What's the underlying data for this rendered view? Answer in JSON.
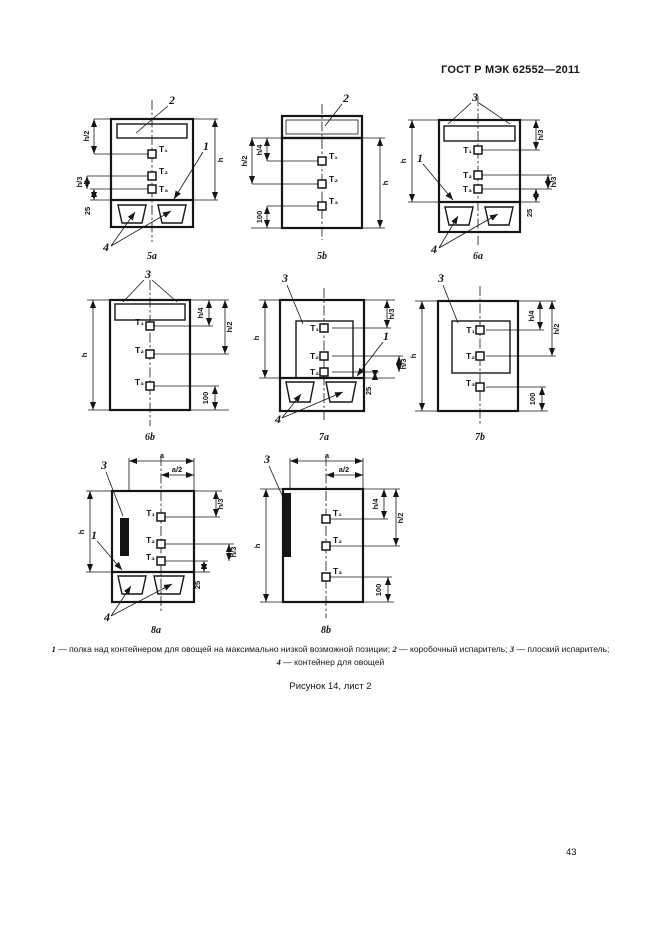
{
  "page": {
    "header": "ГОСТ Р МЭК 62552—2011",
    "figure_caption": "Рисунок 14, лист 2",
    "page_number": "43"
  },
  "colors": {
    "ink": "#151515",
    "paper": "#ffffff"
  },
  "sensors": {
    "t1": "T₁",
    "t2": "T₂",
    "t3": "T₃"
  },
  "callouts": {
    "shelf": "1",
    "box_evaporator": "2",
    "flat_evaporator": "3",
    "container": "4"
  },
  "legend": {
    "items": [
      {
        "num": "1",
        "text": "— полка над контейнером для овощей на максимально низкой возможной позиции; "
      },
      {
        "num": "2",
        "text": "— коробочный испаритель; "
      },
      {
        "num": "3",
        "text": "— плоский испаритель; "
      },
      {
        "num": "4",
        "text": "— контейнер для овощей"
      }
    ]
  },
  "diagrams": {
    "d5a": {
      "caption": "5а",
      "dims": {
        "left_top": "h/2",
        "left_lower": "h/3",
        "left_bottom": "25",
        "right": "h"
      }
    },
    "d5b": {
      "caption": "5b",
      "dims": {
        "left_inner": "h/4",
        "left_outer": "h/2",
        "left_bottom": "100",
        "right": "h"
      }
    },
    "d6a": {
      "caption": "6а",
      "dims": {
        "left": "h",
        "right_top": "h/3",
        "right_mid": "h/3",
        "right_bottom": "25"
      }
    },
    "d6b": {
      "caption": "6b",
      "dims": {
        "left": "h",
        "right_inner": "h/4",
        "right_outer": "h/2",
        "right_bottom": "100"
      }
    },
    "d7a": {
      "caption": "7а",
      "dims": {
        "left": "h",
        "right_top": "h/3",
        "right_mid": "h/3",
        "right_bottom": "25"
      }
    },
    "d7b": {
      "caption": "7b",
      "dims": {
        "left": "h",
        "right_inner": "h/4",
        "right_outer": "h/2",
        "right_bottom": "100"
      }
    },
    "d8a": {
      "caption": "8а",
      "dims": {
        "top_width": "a",
        "top_half": "a/2",
        "left": "h",
        "right_top": "h/3",
        "right_mid": "h/3",
        "right_bottom": "25"
      }
    },
    "d8b": {
      "caption": "8b",
      "dims": {
        "top_width": "a",
        "top_half": "a/2",
        "left": "h",
        "right_inner": "h/4",
        "right_outer": "h/2",
        "right_bottom": "100"
      }
    }
  }
}
